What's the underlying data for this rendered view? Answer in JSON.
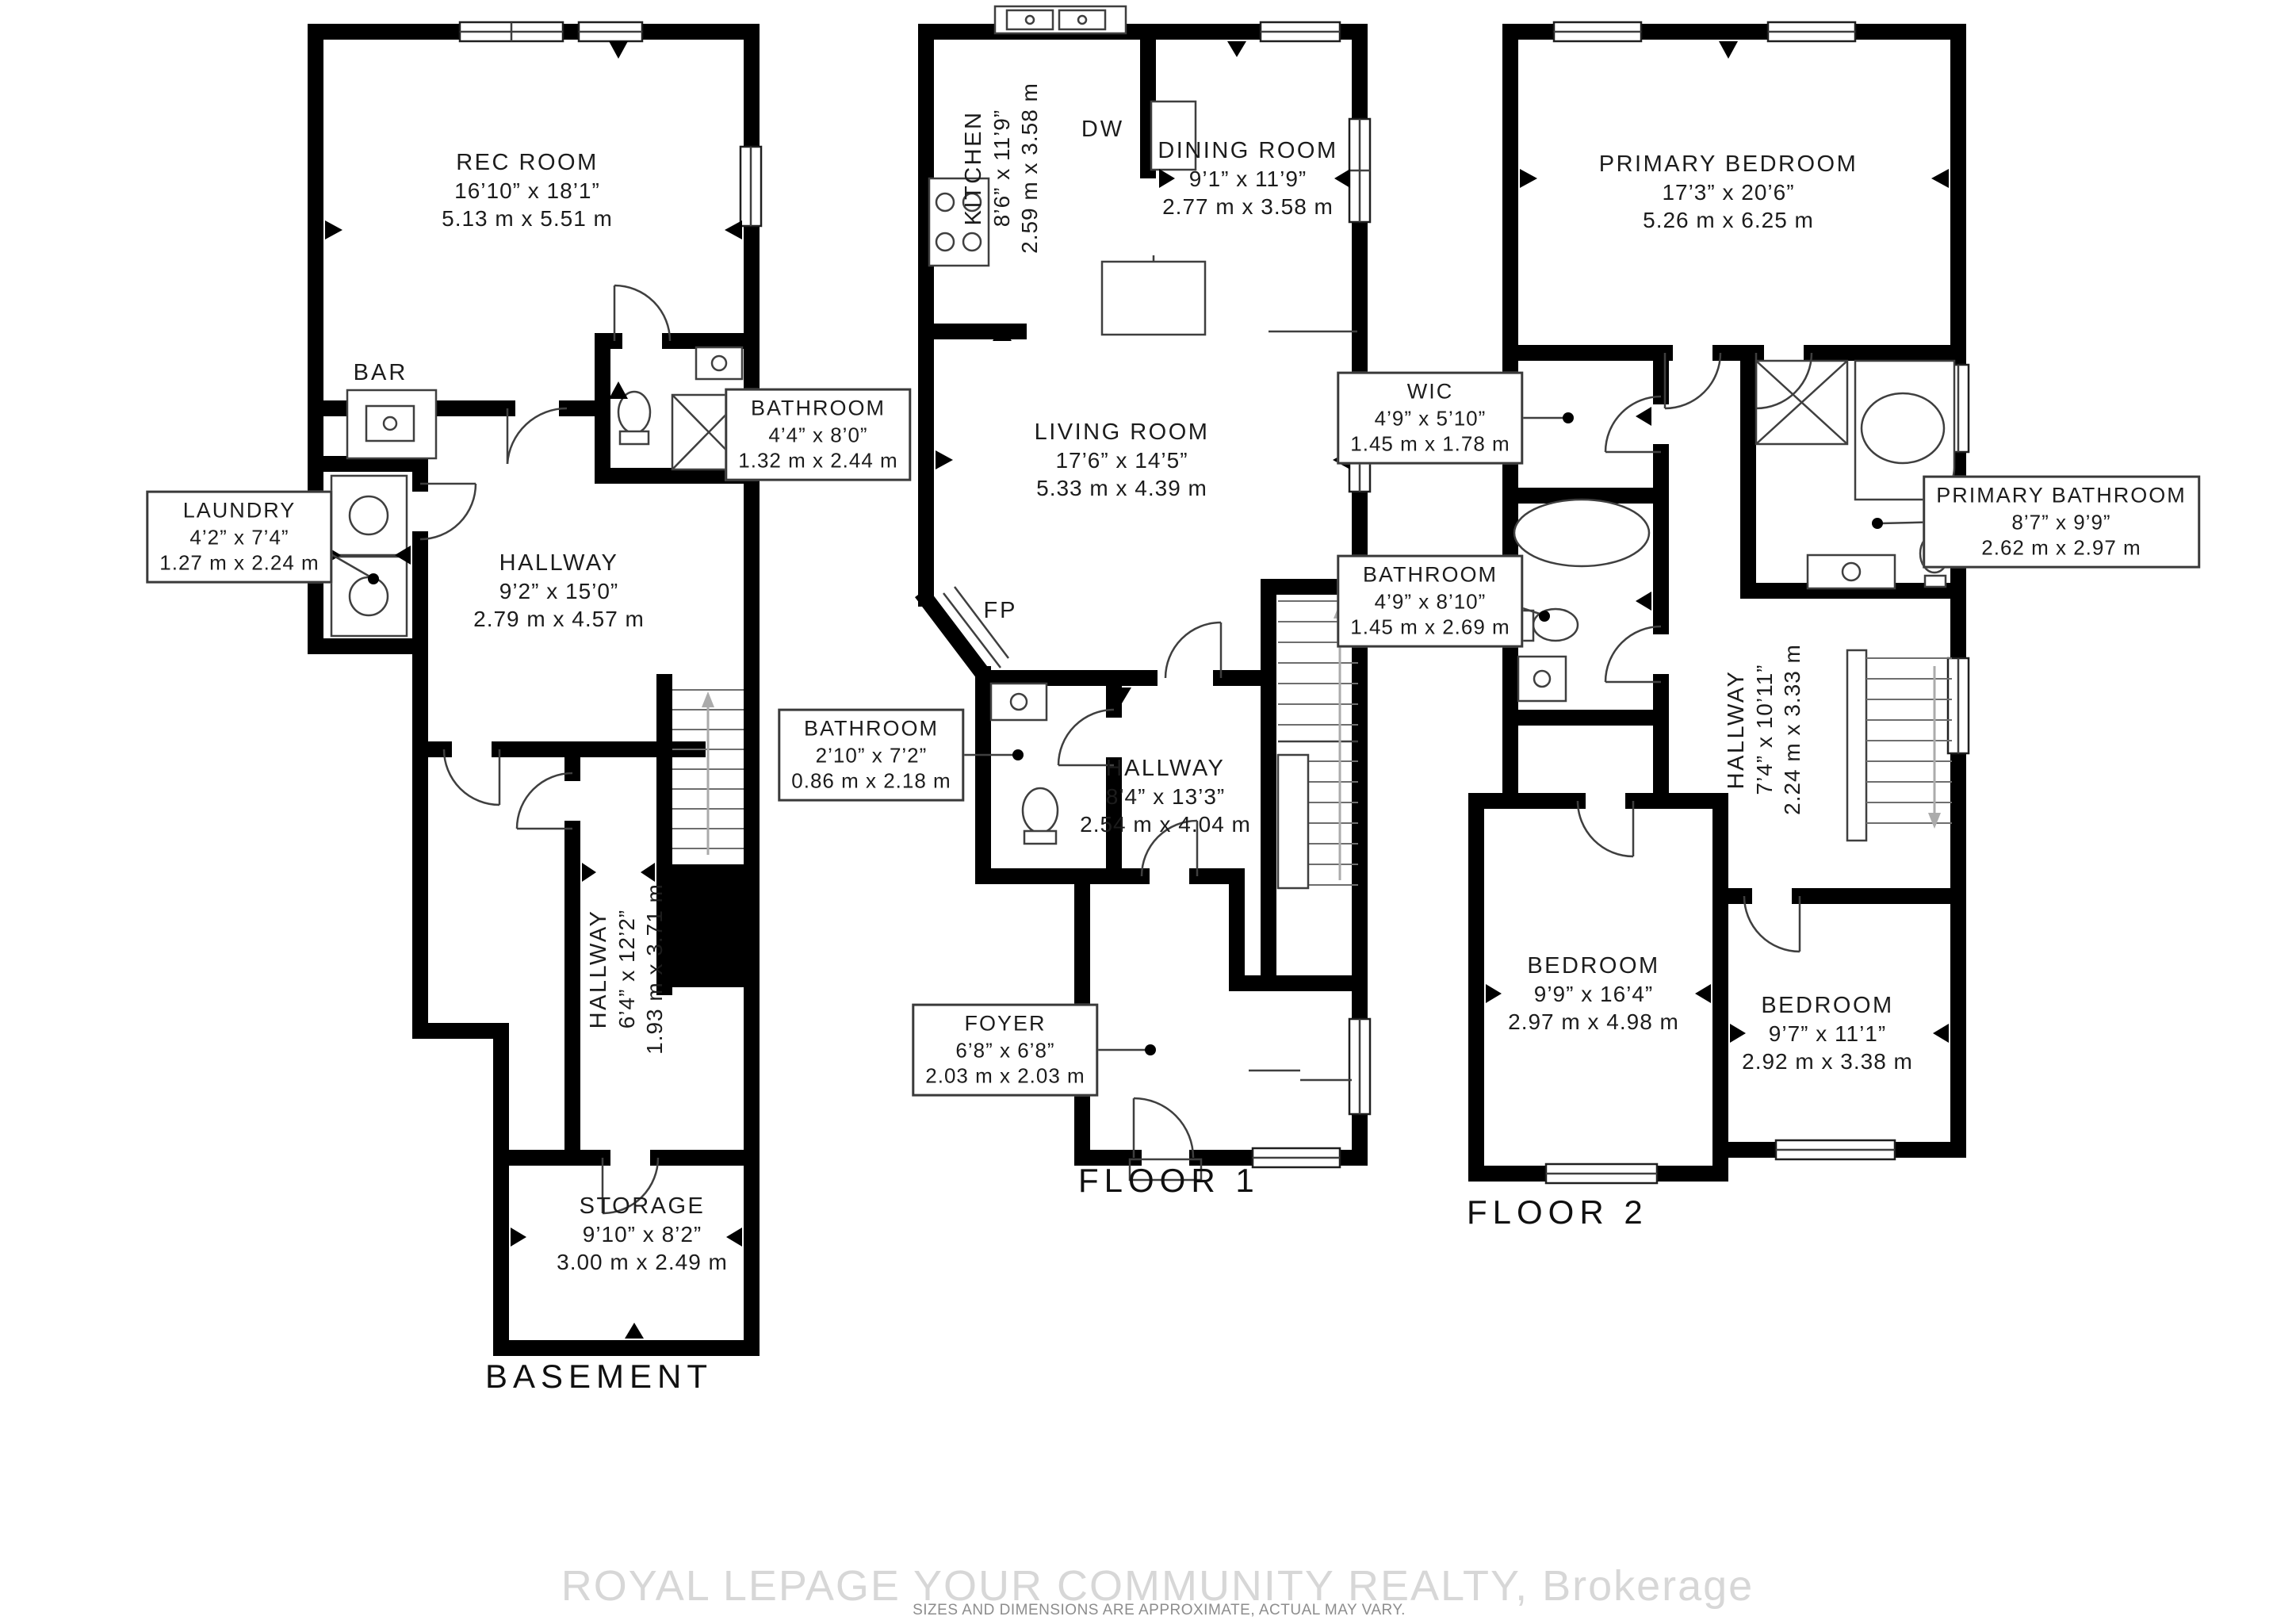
{
  "floors": {
    "basement": {
      "title": "BASEMENT",
      "rooms": {
        "rec_room": {
          "name": "REC ROOM",
          "imperial": "16’10” x 18’1”",
          "metric": "5.13 m x 5.51 m"
        },
        "bar": {
          "name": "BAR"
        },
        "laundry": {
          "name": "LAUNDRY",
          "imperial": "4’2” x 7’4”",
          "metric": "1.27 m x 2.24 m"
        },
        "hallway": {
          "name": "HALLWAY",
          "imperial": "9’2” x 15’0”",
          "metric": "2.79 m x 4.57 m"
        },
        "bathroom": {
          "name": "BATHROOM",
          "imperial": "4’4” x 8’0”",
          "metric": "1.32 m x 2.44 m"
        },
        "lower_hallway": {
          "name": "HALLWAY",
          "imperial": "6’4” x 12’2”",
          "metric": "1.93 m x 3.71 m"
        },
        "storage": {
          "name": "STORAGE",
          "imperial": "9’10” x 8’2”",
          "metric": "3.00 m x 2.49 m"
        }
      }
    },
    "floor1": {
      "title": "FLOOR 1",
      "rooms": {
        "kitchen": {
          "name": "KITCHEN",
          "imperial": "8’6” x 11’9”",
          "metric": "2.59 m x 3.58 m"
        },
        "dw": {
          "name": "DW"
        },
        "dining_room": {
          "name": "DINING ROOM",
          "imperial": "9’1” x 11’9”",
          "metric": "2.77 m x 3.58 m"
        },
        "living_room": {
          "name": "LIVING ROOM",
          "imperial": "17’6” x 14’5”",
          "metric": "5.33 m x 4.39 m"
        },
        "fp": {
          "name": "FP"
        },
        "bathroom": {
          "name": "BATHROOM",
          "imperial": "2’10” x 7’2”",
          "metric": "0.86 m x 2.18 m"
        },
        "hallway": {
          "name": "HALLWAY",
          "imperial": "8’4” x 13’3”",
          "metric": "2.54 m x 4.04 m"
        },
        "foyer": {
          "name": "FOYER",
          "imperial": "6’8” x 6’8”",
          "metric": "2.03 m x 2.03 m"
        }
      }
    },
    "floor2": {
      "title": "FLOOR 2",
      "rooms": {
        "primary_bedroom": {
          "name": "PRIMARY BEDROOM",
          "imperial": "17’3” x 20’6”",
          "metric": "5.26 m x 6.25 m"
        },
        "wic": {
          "name": "WIC",
          "imperial": "4’9” x 5’10”",
          "metric": "1.45 m x 1.78 m"
        },
        "bathroom": {
          "name": "BATHROOM",
          "imperial": "4’9” x 8’10”",
          "metric": "1.45 m x 2.69 m"
        },
        "primary_bathroom": {
          "name": "PRIMARY BATHROOM",
          "imperial": "8’7” x 9’9”",
          "metric": "2.62 m x 2.97 m"
        },
        "hallway": {
          "name": "HALLWAY",
          "imperial": "7’4” x 10’11”",
          "metric": "2.24 m x 3.33 m"
        },
        "bedroom1": {
          "name": "BEDROOM",
          "imperial": "9’9” x 16’4”",
          "metric": "2.97 m x 4.98 m"
        },
        "bedroom2": {
          "name": "BEDROOM",
          "imperial": "9’7” x 11’1”",
          "metric": "2.92 m x 3.38 m"
        }
      }
    }
  },
  "watermark": {
    "brand": "ROYAL LEPAGE YOUR COMMUNITY REALTY, Brokerage",
    "disclaimer": "SIZES AND DIMENSIONS ARE APPROXIMATE, ACTUAL MAY VARY."
  },
  "colors": {
    "wall": "#000000",
    "fixture": "#3f3f3f",
    "watermark_brand": "#d7d7d7",
    "watermark_text": "#8d8d8d"
  }
}
